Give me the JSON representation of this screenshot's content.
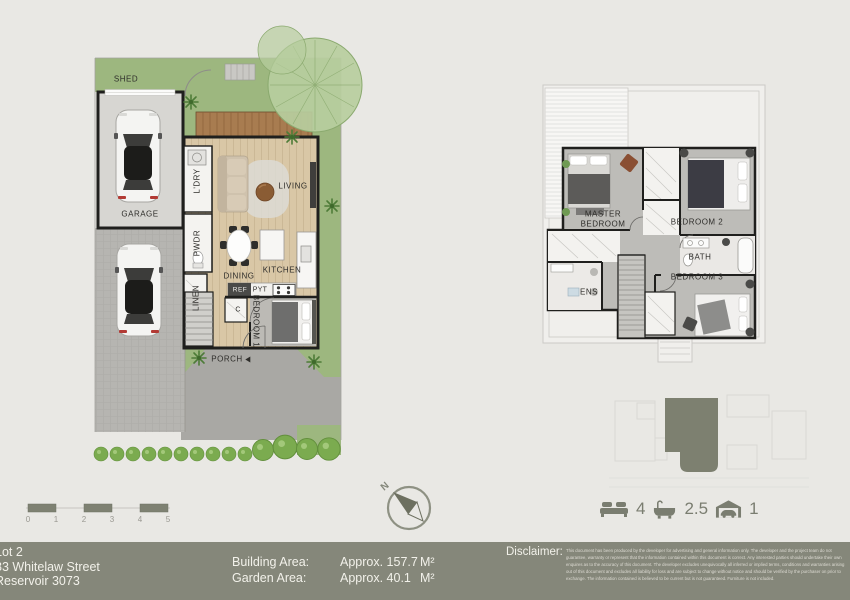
{
  "ground_floor": {
    "labels": {
      "shed": "SHED",
      "garage": "GARAGE",
      "laundry": "L'DRY",
      "powder": "PWDR",
      "linen": "LINEN",
      "living": "LIVING",
      "dining": "DINING",
      "kitchen": "KITCHEN",
      "fridge": "REF",
      "pantry": "PYT",
      "cupboard": "C",
      "bedroom1": "BEDROOM 1",
      "porch": "PORCH"
    }
  },
  "first_floor": {
    "labels": {
      "master_line1": "MASTER",
      "master_line2": "BEDROOM",
      "bedroom2": "BEDROOM 2",
      "bath": "BATH",
      "bedroom3": "BEDROOM 3",
      "ensuite": "ENS"
    }
  },
  "scale_bar": {
    "ticks": [
      "0",
      "1",
      "2",
      "3",
      "4",
      "5"
    ]
  },
  "compass": {
    "north": "N"
  },
  "summary": {
    "beds": "4",
    "baths": "2.5",
    "cars": "1"
  },
  "footer": {
    "address": {
      "lot": "Lot 2",
      "street": "83 Whitelaw Street",
      "suburb": "Reservoir 3073"
    },
    "areas": {
      "building_label": "Building Area:",
      "building_value": "Approx. 157.7",
      "building_unit": "M²",
      "garden_label": "Garden Area:",
      "garden_value": "Approx. 40.1",
      "garden_unit": "M²"
    },
    "disclaimer_label": "Disclaimer:",
    "disclaimer_text": "This document has been produced by the developer for advertising and general information only. The developer and the project team do not guarantee, warranty or represent that the information contained within this document is correct. Any interested parties should undertake their own enquires as to the accuracy of this document. The developer excludes unequivocally all inferred or implied terms, conditions and warranties arising out of this document and excludes all liability for loss and are subject to change without notice and should be verified by the purchaser on prior to exchange. The information contained is believed to be current but is not guaranteed. Furniture is not included."
  },
  "colors": {
    "footer_bg": "#85877a",
    "lawn": "#9db77f",
    "deck": "#a87c50",
    "lot_fill": "#7d8070",
    "icon_accent": "#7a7d70"
  }
}
